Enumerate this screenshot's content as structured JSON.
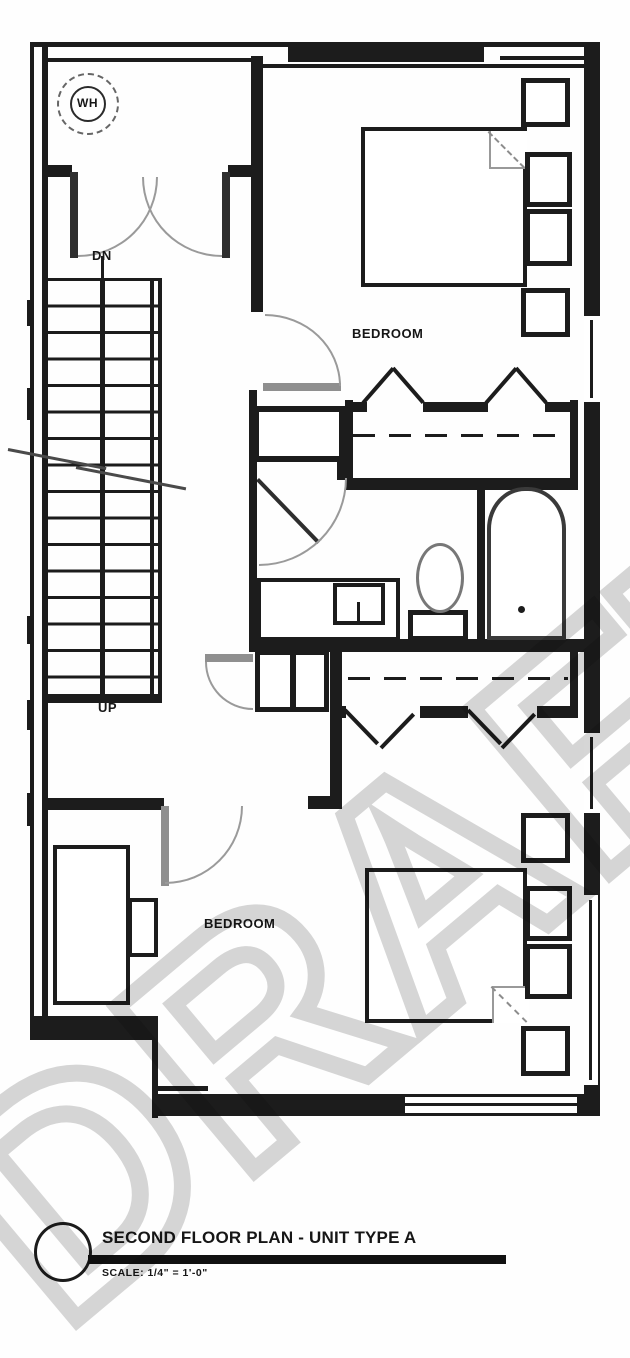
{
  "floor_plan": {
    "watermark": "DRAFT",
    "rooms": {
      "bedroom_1_label": "BEDROOM",
      "bedroom_2_label": "BEDROOM"
    },
    "stairs": {
      "down_label": "DN",
      "up_label": "UP"
    },
    "fixtures": {
      "water_heater_label": "WH",
      "icons": [
        "bathtub-icon",
        "toilet-icon",
        "sink-vanity-icon",
        "bed-icon",
        "closet-rod-icon",
        "bifold-door-icon",
        "door-swing-icon",
        "stairs-icon",
        "water-heater-icon"
      ]
    },
    "title_block": {
      "title": "SECOND FLOOR PLAN - UNIT TYPE A",
      "scale": "SCALE: 1/4\" = 1'-0\""
    },
    "colors": {
      "line": "#1c1c1c",
      "door_leaf": "#8f8f8f",
      "fixture_gray": "#777777",
      "watermark": "#c9c9c9",
      "paper": "#ffffff"
    }
  }
}
